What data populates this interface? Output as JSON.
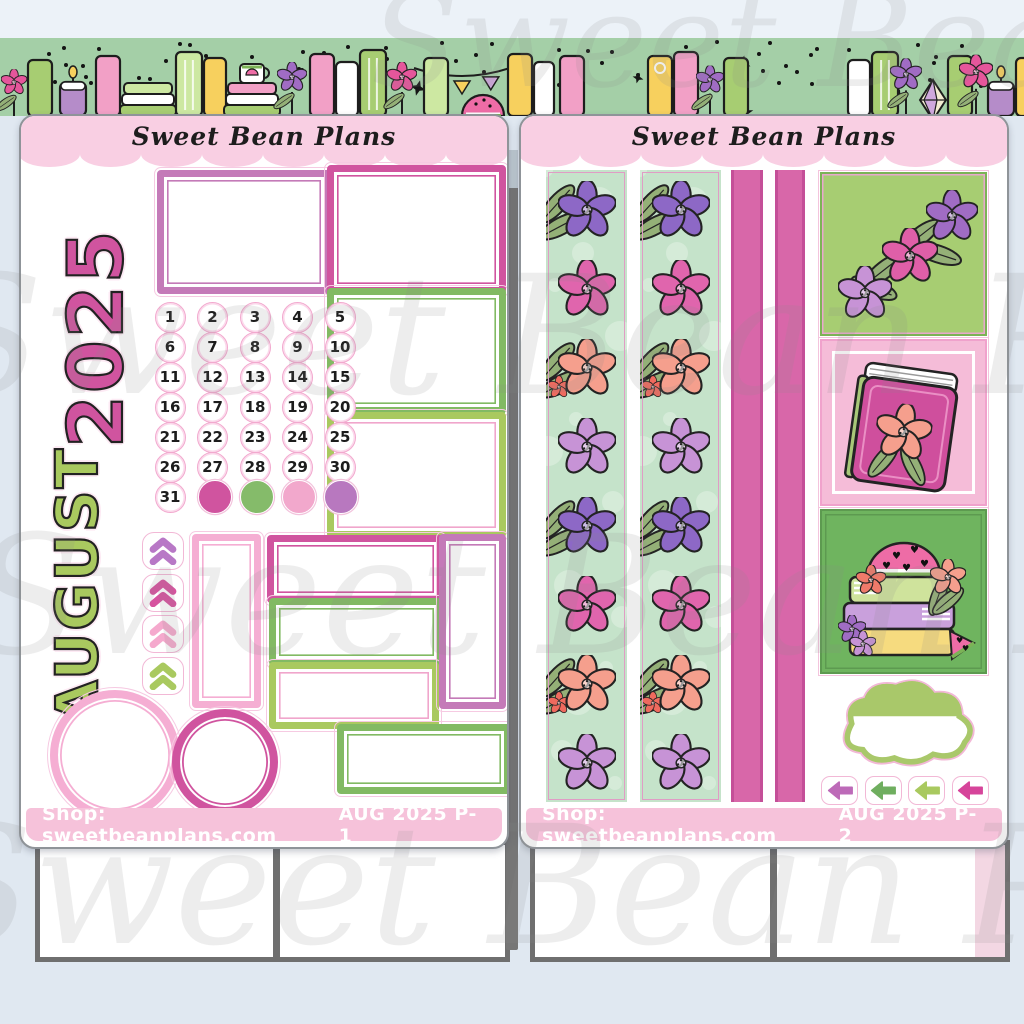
{
  "watermark": {
    "text": "Sweet Bean Plans"
  },
  "palette": {
    "bg_blue": "#e0e8f1",
    "banner_green": "#a4cfa7",
    "sheet_border": "#8f9499",
    "header_pink": "#f9cfe3",
    "bar_pink": "#f6c2da",
    "pink_dark": "#d0549f",
    "pink_light": "#f5aed3",
    "orchid": "#c47ab8",
    "green_mid": "#82ba63",
    "green_lime": "#a9c95f",
    "green_sage": "#94b077",
    "mint": "#c5e3ca",
    "strip_pink": "#d867a9",
    "strip_pink_edge": "#c44f98",
    "box_green_bg": "#a7cd72",
    "box_green_dark": "#6fb45f",
    "watermark_gray": "#8a8a8a",
    "rod_gray": "#767676",
    "bottom_border_gray": "#6f6f6f",
    "bottom_strip_pink": "#f3d7e3"
  },
  "banner": {
    "bg_color": "#a4cfa7",
    "dot_color": "#141414",
    "palette": {
      "green_book": "#a7cd72",
      "green_book_light": "#cde8a2",
      "pink_book": "#f2a0c6",
      "pink_hot": "#e5569b",
      "yellow_book": "#f7d05e",
      "white_book": "#ffffff",
      "purple_flower": "#a06cc4",
      "candle_purple": "#b58cc9",
      "leaf_sage": "#94b077",
      "melon_pink": "#ee6ca6",
      "rind_green": "#7cb356",
      "gem_cream": "#f3ecd2",
      "gem_purple": "#cfa8dd"
    }
  },
  "sheets": [
    {
      "brand": "Sweet Bean Plans",
      "page_label": "AUG 2025 P-1",
      "shop_label": "Shop: sweetbeanplans.com",
      "year_text": "2025",
      "month_text": "AUGUST",
      "date_numbers": [
        "1",
        "2",
        "3",
        "4",
        "5",
        "6",
        "7",
        "8",
        "9",
        "10",
        "11",
        "12",
        "13",
        "14",
        "15",
        "16",
        "17",
        "18",
        "19",
        "20",
        "21",
        "22",
        "23",
        "24",
        "25",
        "26",
        "27",
        "28",
        "29",
        "30",
        "31"
      ],
      "date_dot_colors": [
        "#d0549f",
        "#85bb6a",
        "#f2a8cc",
        "#b878bf"
      ],
      "chevron_colors": [
        "#b878c6",
        "#d6539f",
        "#f5a9cd",
        "#a9c95f"
      ]
    },
    {
      "brand": "Sweet Bean Plans",
      "page_label": "AUG 2025 P-2",
      "shop_label": "Shop: sweetbeanplans.com",
      "arrow_colors": [
        "#bd6ab8",
        "#6fae5f",
        "#a9c95f",
        "#d6449a"
      ],
      "washi": {
        "bg": "#c5e3ca",
        "flower_colors": {
          "purple": "#8d68c6",
          "pink": "#e065ad",
          "peach": "#f59f8d",
          "lilac": "#c793d6",
          "coral": "#ef6a5e"
        },
        "sequence": [
          "purple",
          "pink",
          "peach",
          "lilac",
          "purple",
          "pink",
          "peach",
          "lilac"
        ]
      }
    }
  ]
}
